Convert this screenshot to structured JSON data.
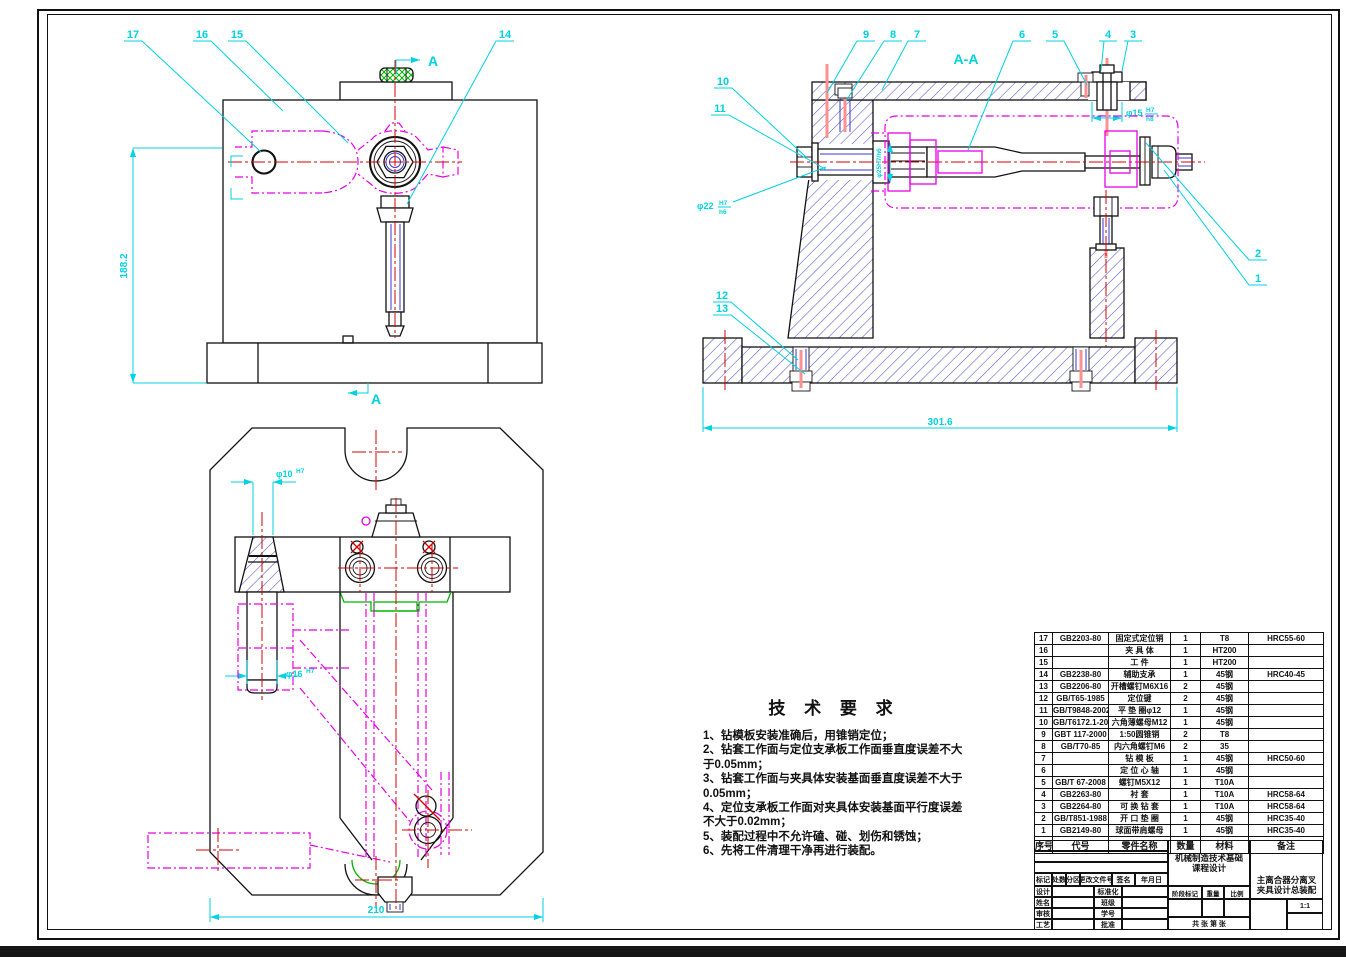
{
  "labels": {
    "section_view": "A-A",
    "section_arrow": "A"
  },
  "balloons": {
    "1": "1",
    "2": "2",
    "3": "3",
    "4": "4",
    "5": "5",
    "6": "6",
    "7": "7",
    "8": "8",
    "9": "9",
    "10": "10",
    "11": "11",
    "12": "12",
    "13": "13",
    "14": "14",
    "15": "15",
    "16": "16",
    "17": "17"
  },
  "dimensions": {
    "front_height": "188.2",
    "base_length": "301.6",
    "plan_width": "210",
    "d22": {
      "dia": "φ22",
      "upper": "H7",
      "lower": "h6"
    },
    "d25": {
      "text": "φ25H7/h6"
    },
    "d15": {
      "dia": "φ15",
      "upper": "H7",
      "lower": "h8"
    },
    "d10": {
      "dia": "φ10",
      "tol": "H7"
    },
    "d16": {
      "dia": "φ16",
      "tol": "H7"
    }
  },
  "tech_requirements": {
    "title": "技 术 要 求",
    "items": [
      "1、钻模板安装准确后，用锥销定位；",
      "2、钻套工作面与定位支承板工作面垂直度误差不大于0.05mm；",
      "3、钻套工作面与夹具体安装基面垂直度误差不大于0.05mm；",
      "4、定位支承板工作面对夹具体安装基面平行度误差不大于0.02mm；",
      "5、装配过程中不允许磕、碰、划伤和锈蚀；",
      "6、先将工件清理干净再进行装配。"
    ]
  },
  "bom": {
    "headers": [
      "序号",
      "代号",
      "零件名称",
      "数量",
      "材料",
      "备注"
    ],
    "rows": [
      [
        "17",
        "GB2203-80",
        "固定式定位销",
        "1",
        "T8",
        "HRC55-60"
      ],
      [
        "16",
        "",
        "夹 具 体",
        "1",
        "HT200",
        ""
      ],
      [
        "15",
        "",
        "工  件",
        "1",
        "HT200",
        ""
      ],
      [
        "14",
        "GB2238-80",
        "辅助支承",
        "1",
        "45钢",
        "HRC40-45"
      ],
      [
        "13",
        "GB2206-80",
        "开槽螺钉M6X16",
        "2",
        "45钢",
        ""
      ],
      [
        "12",
        "GB/T65-1985",
        "定位键",
        "2",
        "45钢",
        ""
      ],
      [
        "11",
        "GB/T9848-2002",
        "平 垫 圈φ12",
        "1",
        "45钢",
        ""
      ],
      [
        "10",
        "GB/T6172.1-2000",
        "六角薄螺母M12",
        "1",
        "45钢",
        ""
      ],
      [
        "9",
        "GBT 117-2000",
        "1:50圆锥销",
        "2",
        "T8",
        ""
      ],
      [
        "8",
        "GB/T70-85",
        "内六角螺钉M6",
        "2",
        "35",
        ""
      ],
      [
        "7",
        "",
        "钻 模 板",
        "1",
        "45钢",
        "HRC50-60"
      ],
      [
        "6",
        "",
        "定 位 心 轴",
        "1",
        "45钢",
        ""
      ],
      [
        "5",
        "GB/T 67-2008",
        "螺钉M5X12",
        "1",
        "T10A",
        ""
      ],
      [
        "4",
        "GB2263-80",
        "衬  套",
        "1",
        "T10A",
        "HRC58-64"
      ],
      [
        "3",
        "GB2264-80",
        "可 换 钻 套",
        "1",
        "T10A",
        "HRC58-64"
      ],
      [
        "2",
        "GB/T851-1988",
        "开 口 垫 圈",
        "1",
        "45钢",
        "HRC35-40"
      ],
      [
        "1",
        "GB2149-80",
        "球面带肩螺母",
        "1",
        "45钢",
        "HRC35-40"
      ]
    ]
  },
  "title_block": {
    "course_line1": "机械制造技术基础",
    "course_line2": "课程设计",
    "title_line1": "主离合器分离叉",
    "title_line2": "夹具设计总装配",
    "row_labels": [
      "标记",
      "处数",
      "分区",
      "更改文件号",
      "签名",
      "年月日"
    ],
    "left_rows": [
      [
        "设计",
        "标准化"
      ],
      [
        "姓名",
        "班级"
      ],
      [
        "审核",
        "学号"
      ],
      [
        "工艺",
        "批准"
      ]
    ],
    "stage_labels": [
      "阶段标记",
      "重量",
      "比例"
    ],
    "scale": "1:1",
    "sheet_info": "共 张 第 张"
  }
}
